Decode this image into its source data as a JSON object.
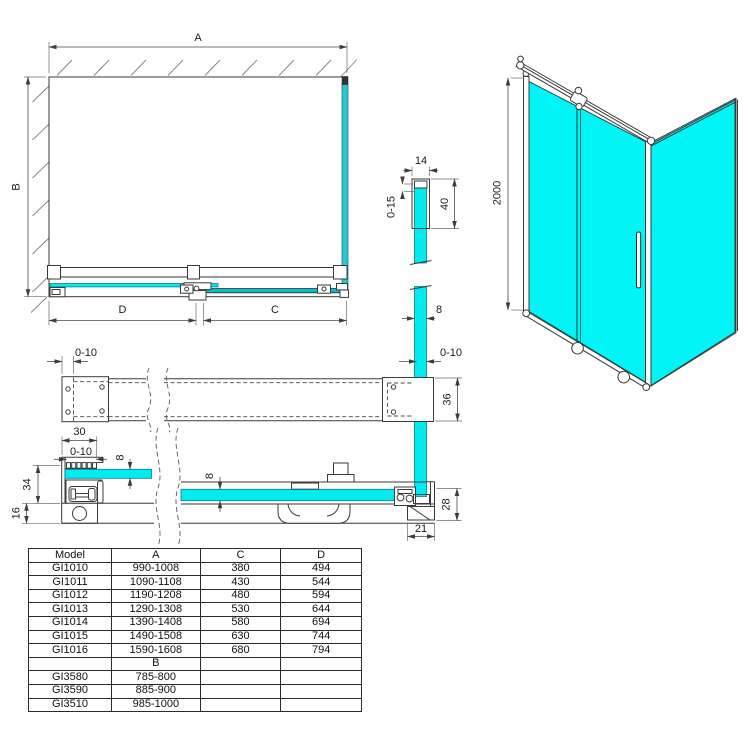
{
  "drawing": {
    "front": {
      "a": "A",
      "b": "B",
      "c": "C",
      "d": "D"
    },
    "top_profile": {
      "width": "14",
      "glass_adjust": "0-15",
      "profile_height": "40",
      "glass_thickness": "8",
      "wall_adjust": "0-10"
    },
    "rail_plan": {
      "wall_adjust": "0-10",
      "bracket_depth": "36"
    },
    "bottom_profile": {
      "width": "30",
      "adjust": "0-10",
      "glass_thickness": "8",
      "height": "34",
      "base_height": "16",
      "door_glass_thickness": "8",
      "corner_height": "28",
      "corner_depth": "21"
    },
    "iso": {
      "height": "2000"
    }
  },
  "colors": {
    "glass": "#00f2f4",
    "glass_edge": "#0a7d84"
  },
  "table": {
    "headers": [
      "Model",
      "A",
      "C",
      "D"
    ],
    "rows": [
      [
        "GI1010",
        "990-1008",
        "380",
        "494"
      ],
      [
        "GI1011",
        "1090-1108",
        "430",
        "544"
      ],
      [
        "GI1012",
        "1190-1208",
        "480",
        "594"
      ],
      [
        "GI1013",
        "1290-1308",
        "530",
        "644"
      ],
      [
        "GI1014",
        "1390-1408",
        "580",
        "694"
      ],
      [
        "GI1015",
        "1490-1508",
        "630",
        "744"
      ],
      [
        "GI1016",
        "1590-1608",
        "680",
        "794"
      ]
    ],
    "b_section_label": "B",
    "b_rows": [
      [
        "GI3580",
        "785-800"
      ],
      [
        "GI3590",
        "885-900"
      ],
      [
        "GI3510",
        "985-1000"
      ]
    ]
  }
}
